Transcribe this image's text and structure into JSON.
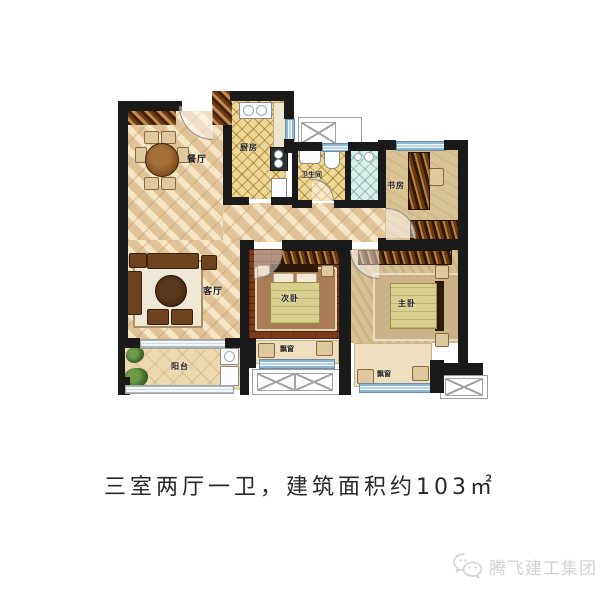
{
  "caption": "三室两厅一卫，建筑面积约103㎡",
  "watermark": {
    "brand": "腾飞建工集团",
    "icon": "wechat-icon"
  },
  "plan": {
    "rooms": {
      "dining": "餐厅",
      "kitchen": "厨房",
      "bathroom": "卫生间",
      "study": "书房",
      "living": "客厅",
      "bedroom_second": "次卧",
      "bedroom_master": "主卧",
      "balcony": "阳台",
      "bay_window_second": "飘窗",
      "bay_window_master": "飘窗"
    },
    "colors": {
      "wall": "#1a1a1a",
      "window_glass": "#b9d8ec",
      "tile_floor": "#e9d2a6",
      "dark_wood_floor": "#7c3a1a",
      "caption_text": "#282828",
      "watermark_gray": "#d2d2d2"
    }
  }
}
